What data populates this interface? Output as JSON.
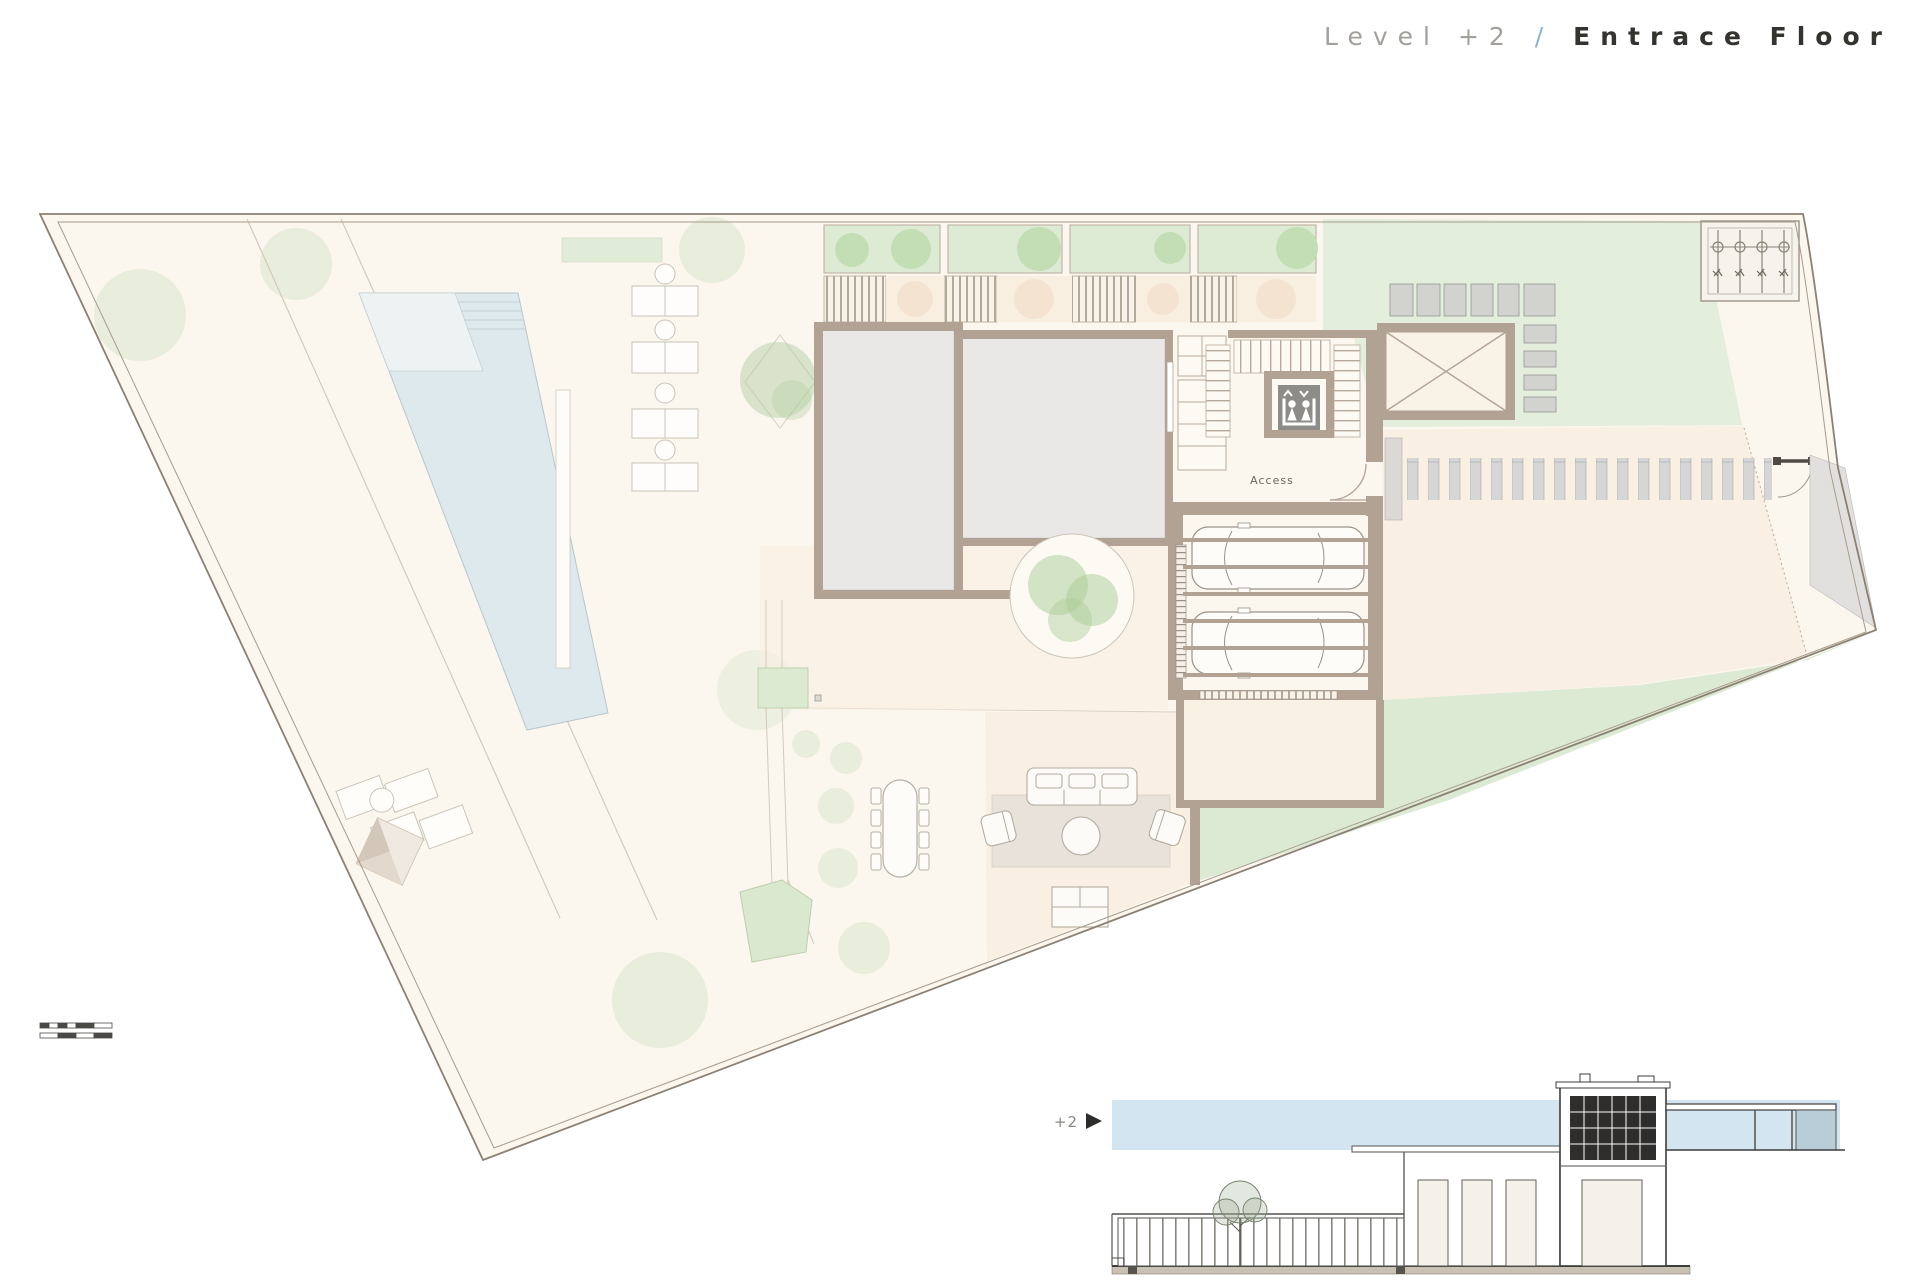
{
  "title": {
    "level": "Level +2",
    "separator": "/",
    "name": "Entrace Floor"
  },
  "plan": {
    "access_label": "Access"
  },
  "section": {
    "level_marker": "+2"
  },
  "colors": {
    "paper": "#ffffff",
    "site_fill": "#fbf6ee",
    "terrace_fill": "#f9efe2",
    "wall_tan": "#b2a294",
    "room_gray": "#eae8e6",
    "lawn_green": "#e3eedd",
    "planter_green": "#ddebd5",
    "tree_green": "#c3ddb4",
    "pool_blue": "#dde9ec",
    "paver_gray": "#d2d2cf",
    "boundary_line": "#8b8073",
    "sky_band_blue": "#d3e5f1",
    "section_line": "#3f3d3a",
    "title_gray": "#a3a09b",
    "title_slash_blue": "#8fb3cd",
    "title_dark": "#34332f",
    "elevator_cab_gray": "#8e8c89"
  }
}
